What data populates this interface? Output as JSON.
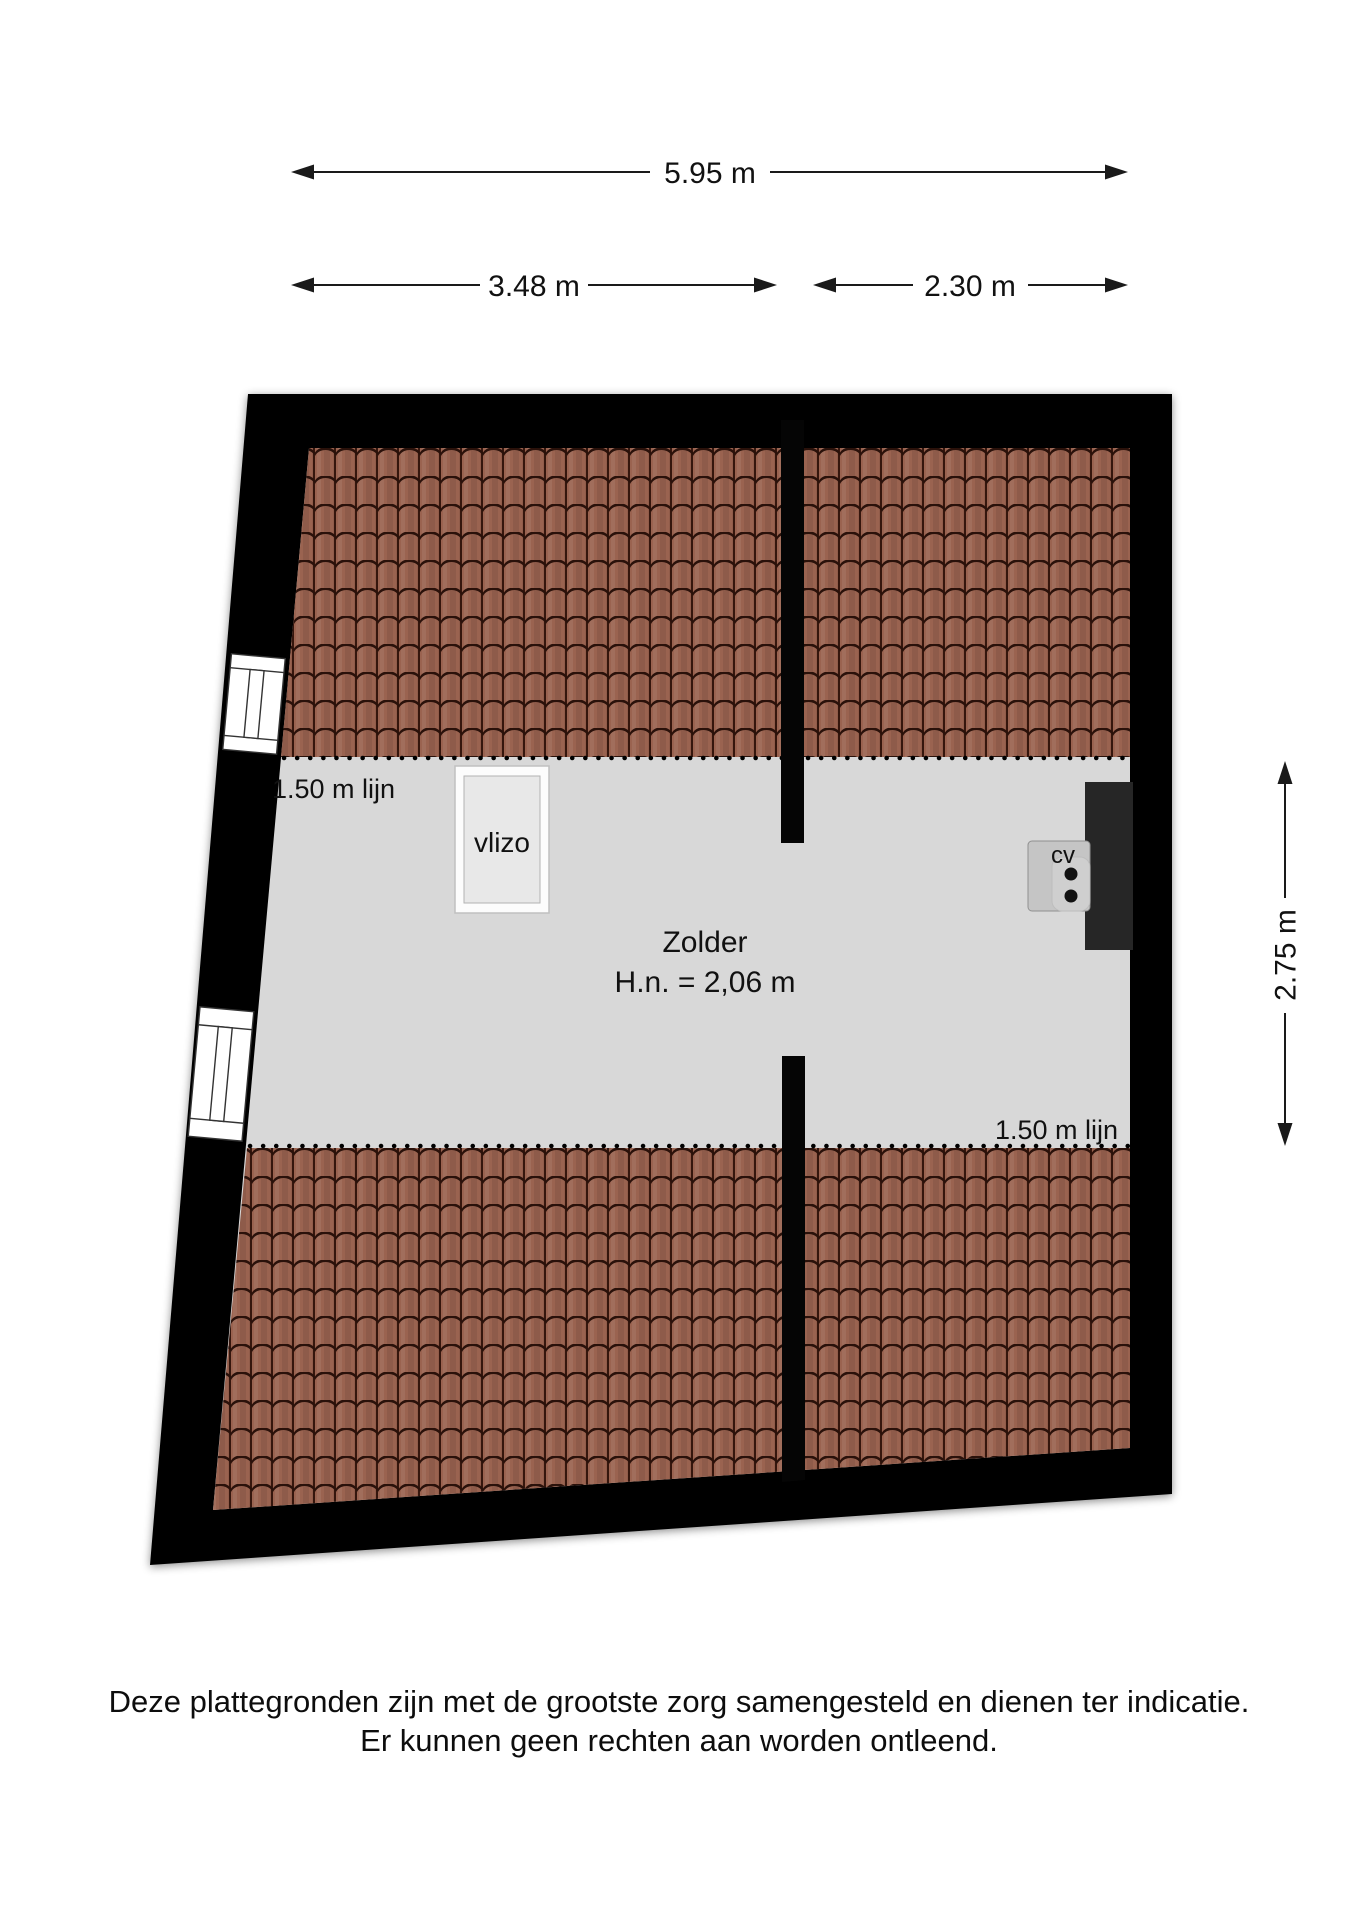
{
  "title": "Zolder plattegrond",
  "dimensions": {
    "total_width": "5.95 m",
    "width_left": "3.48 m",
    "width_right": "2.30 m",
    "height_right": "2.75 m"
  },
  "room": {
    "name": "Zolder",
    "ceiling_height": "H.n. = 2,06 m",
    "knee_wall_line_left": "1.50 m lijn",
    "knee_wall_line_right": "1.50 m lijn",
    "loft_ladder": "vlizo",
    "boiler": "cv"
  },
  "footer": {
    "line1": "Deze plattegronden zijn met de grootste zorg samengesteld en dienen ter indicatie.",
    "line2": "Er kunnen geen rechten aan worden ontleend."
  },
  "colors": {
    "wall": "#050505",
    "floor": "#d8d8d8",
    "roof_tile": "#9a6350",
    "roof_tile_gap": "#2a110a",
    "chimney": "#262626",
    "background": "#ffffff"
  }
}
